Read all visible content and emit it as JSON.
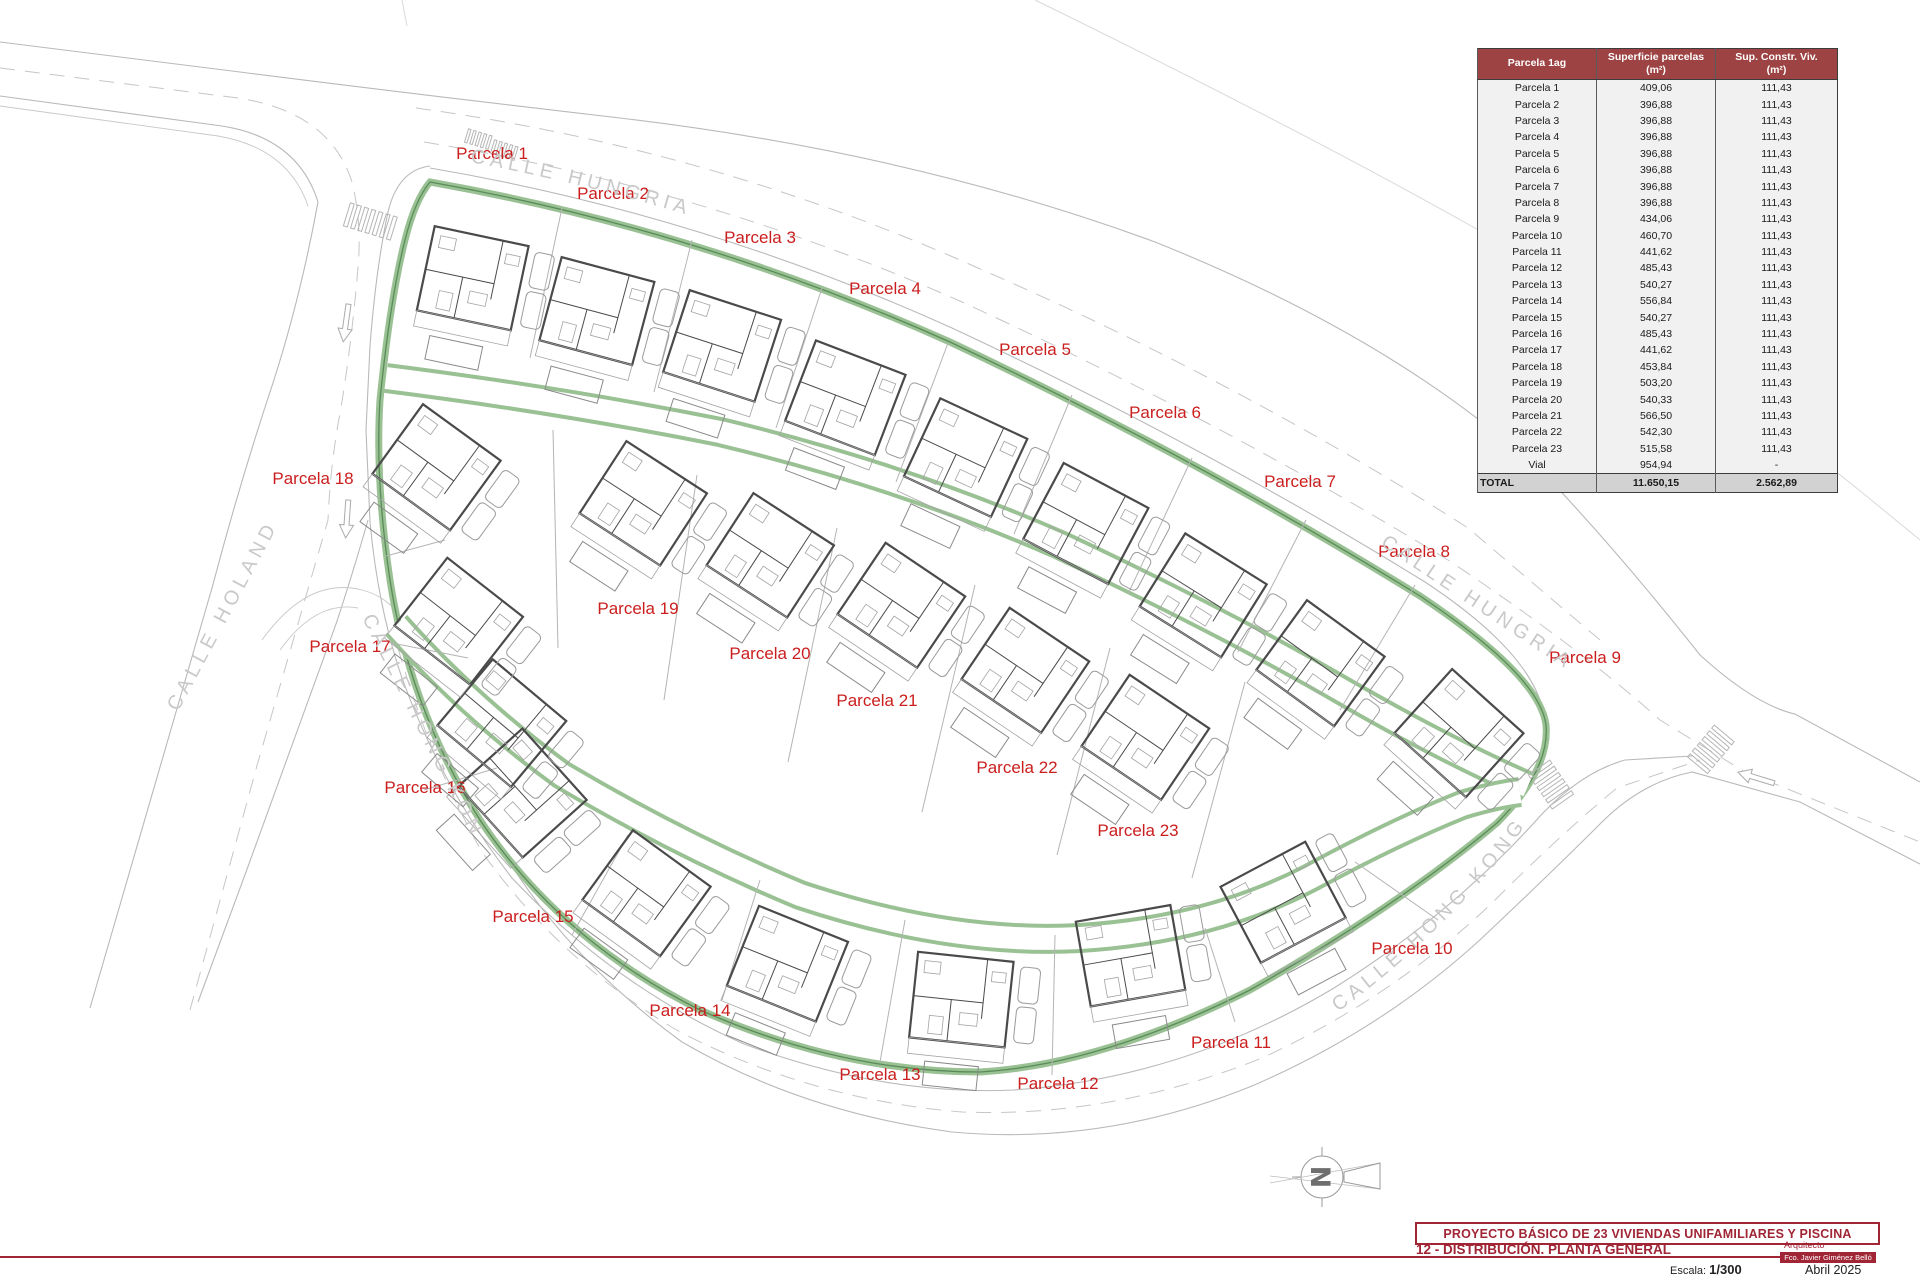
{
  "map": {
    "streets": [
      {
        "id": "hungria-top",
        "name": "CALLE HUNGRIA"
      },
      {
        "id": "hungria-right",
        "name": "CALLE HUNGRIA"
      },
      {
        "id": "holanda",
        "name": "CALLE HOLANDA"
      },
      {
        "id": "hongkong-left",
        "name": "CALLE HONG KONG"
      },
      {
        "id": "hongkong-right",
        "name": "CALLE HONG KONG"
      }
    ],
    "north_letter": "N",
    "parcels": [
      {
        "label": "Parcela 1",
        "x": 492,
        "y": 153,
        "hx": 476,
        "hy": 282,
        "rot": 12
      },
      {
        "label": "Parcela 2",
        "x": 613,
        "y": 193,
        "hx": 600,
        "hy": 315,
        "rot": 15
      },
      {
        "label": "Parcela 3",
        "x": 760,
        "y": 237,
        "hx": 725,
        "hy": 350,
        "rot": 18
      },
      {
        "label": "Parcela 4",
        "x": 885,
        "y": 288,
        "hx": 848,
        "hy": 402,
        "rot": 21
      },
      {
        "label": "Parcela 5",
        "x": 1035,
        "y": 349,
        "hx": 968,
        "hy": 462,
        "rot": 25
      },
      {
        "label": "Parcela 6",
        "x": 1165,
        "y": 412,
        "hx": 1088,
        "hy": 528,
        "rot": 28
      },
      {
        "label": "Parcela 7",
        "x": 1300,
        "y": 481,
        "hx": 1205,
        "hy": 600,
        "rot": 32
      },
      {
        "label": "Parcela 8",
        "x": 1414,
        "y": 551,
        "hx": 1322,
        "hy": 668,
        "rot": 36
      },
      {
        "label": "Parcela 9",
        "x": 1585,
        "y": 657,
        "hx": 1460,
        "hy": 738,
        "rot": 42
      },
      {
        "label": "Parcela 10",
        "x": 1412,
        "y": 948,
        "hx": 1288,
        "hy": 903,
        "rot": -28
      },
      {
        "label": "Parcela 11",
        "x": 1231,
        "y": 1042,
        "hx": 1135,
        "hy": 958,
        "rot": -10
      },
      {
        "label": "Parcela 12",
        "x": 1058,
        "y": 1083,
        "hx": 965,
        "hy": 1003,
        "rot": 6
      },
      {
        "label": "Parcela 13",
        "x": 880,
        "y": 1074,
        "hx": 790,
        "hy": 968,
        "rot": 22
      },
      {
        "label": "Parcela 14",
        "x": 690,
        "y": 1010,
        "hx": 648,
        "hy": 898,
        "rot": 36
      },
      {
        "label": "Parcela 15",
        "x": 533,
        "y": 916,
        "hx": 523,
        "hy": 798,
        "rot": 48
      },
      {
        "label": "Parcela 16",
        "x": 425,
        "y": 787,
        "hx": 503,
        "hy": 728,
        "rot": 40
      },
      {
        "label": "Parcela 17",
        "x": 350,
        "y": 646,
        "hx": 460,
        "hy": 626,
        "rot": 38
      },
      {
        "label": "Parcela 18",
        "x": 313,
        "y": 478,
        "hx": 438,
        "hy": 472,
        "rot": 36
      },
      {
        "label": "Parcela 19",
        "x": 638,
        "y": 608,
        "hx": 645,
        "hy": 508,
        "rot": 33
      },
      {
        "label": "Parcela 20",
        "x": 770,
        "y": 653,
        "hx": 772,
        "hy": 560,
        "rot": 33
      },
      {
        "label": "Parcela 21",
        "x": 877,
        "y": 700,
        "hx": 903,
        "hy": 610,
        "rot": 34
      },
      {
        "label": "Parcela 22",
        "x": 1017,
        "y": 767,
        "hx": 1027,
        "hy": 675,
        "rot": 34
      },
      {
        "label": "Parcela 23",
        "x": 1138,
        "y": 830,
        "hx": 1147,
        "hy": 742,
        "rot": 34
      }
    ]
  },
  "table": {
    "header": {
      "col1": "Parcela 1ag",
      "col2_line1": "Superficie parcelas",
      "col2_line2": "(m²)",
      "col3_line1": "Sup. Constr. Viv.",
      "col3_line2": "(m²)"
    },
    "rows": [
      [
        "Parcela 1",
        "409,06",
        "111,43"
      ],
      [
        "Parcela 2",
        "396,88",
        "111,43"
      ],
      [
        "Parcela 3",
        "396,88",
        "111,43"
      ],
      [
        "Parcela 4",
        "396,88",
        "111,43"
      ],
      [
        "Parcela 5",
        "396,88",
        "111,43"
      ],
      [
        "Parcela 6",
        "396,88",
        "111,43"
      ],
      [
        "Parcela 7",
        "396,88",
        "111,43"
      ],
      [
        "Parcela 8",
        "396,88",
        "111,43"
      ],
      [
        "Parcela 9",
        "434,06",
        "111,43"
      ],
      [
        "Parcela 10",
        "460,70",
        "111,43"
      ],
      [
        "Parcela 11",
        "441,62",
        "111,43"
      ],
      [
        "Parcela 12",
        "485,43",
        "111,43"
      ],
      [
        "Parcela 13",
        "540,27",
        "111,43"
      ],
      [
        "Parcela 14",
        "556,84",
        "111,43"
      ],
      [
        "Parcela 15",
        "540,27",
        "111,43"
      ],
      [
        "Parcela 16",
        "485,43",
        "111,43"
      ],
      [
        "Parcela 17",
        "441,62",
        "111,43"
      ],
      [
        "Parcela 18",
        "453,84",
        "111,43"
      ],
      [
        "Parcela 19",
        "503,20",
        "111,43"
      ],
      [
        "Parcela 20",
        "540,33",
        "111,43"
      ],
      [
        "Parcela 21",
        "566,50",
        "111,43"
      ],
      [
        "Parcela 22",
        "542,30",
        "111,43"
      ],
      [
        "Parcela 23",
        "515,58",
        "111,43"
      ],
      [
        "Vial",
        "954,94",
        "-"
      ]
    ],
    "total": [
      "TOTAL",
      "11.650,15",
      "2.562,89"
    ]
  },
  "titleblock": {
    "project_title": "PROYECTO BÁSICO DE 23 VIVIENDAS UNIFAMILIARES Y PISCINA",
    "sheet_title": "12 - DISTRIBUCIÓN. PLANTA GENERAL",
    "architect_label": "Arquitecto",
    "architect_name": "Fco. Javier Giménez Belló",
    "scale_label": "Escala:",
    "scale_value": "1/300",
    "date": "Abril 2025"
  },
  "colors": {
    "parcel_label": "#cb1e1e",
    "title_red": "#a02535",
    "table_header": "#9d4343",
    "green_band": "#9ac194",
    "green_edge": "#5a8c58",
    "road_gray": "#b9b9b9"
  }
}
